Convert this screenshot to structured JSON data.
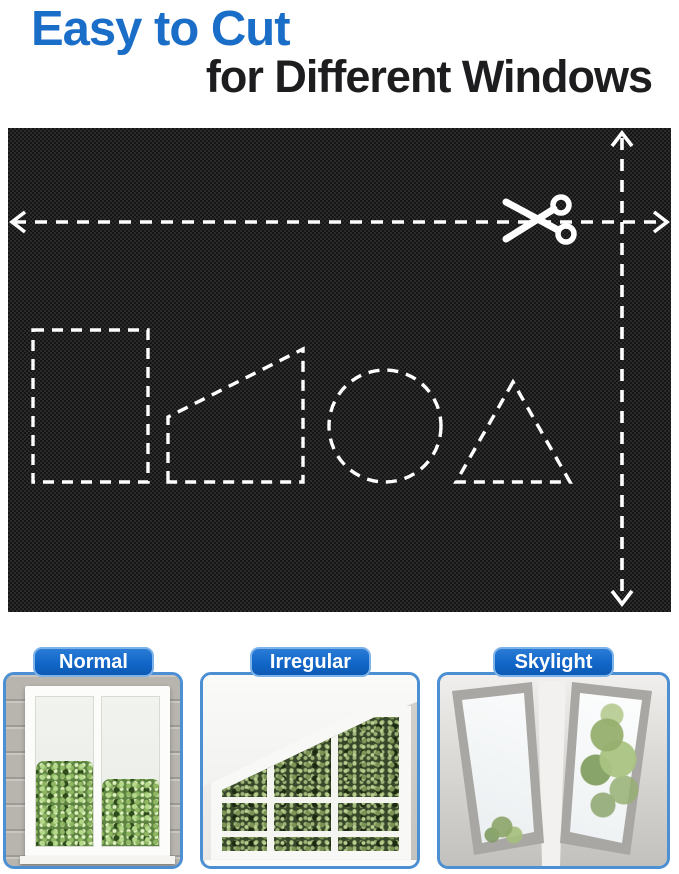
{
  "header": {
    "title": "Easy to Cut",
    "subtitle": "for Different Windows"
  },
  "fabric_panel": {
    "icons": [
      "scissors-icon",
      "left-arrow-icon",
      "right-arrow-icon",
      "up-arrow-icon",
      "down-arrow-icon"
    ],
    "cut_shapes": [
      "rectangle",
      "trapezoid",
      "circle",
      "triangle"
    ],
    "fabric_color": "#151515",
    "guide_color": "#ffffff"
  },
  "cards": [
    {
      "label": "Normal"
    },
    {
      "label": "Irregular"
    },
    {
      "label": "Skylight"
    }
  ],
  "colors": {
    "title_blue": "#1b6ec8",
    "subtitle_black": "#1d1d1f",
    "pill_blue": "#1166c8",
    "pill_border": "#7db3e8",
    "card_border": "#4d8fd3"
  }
}
